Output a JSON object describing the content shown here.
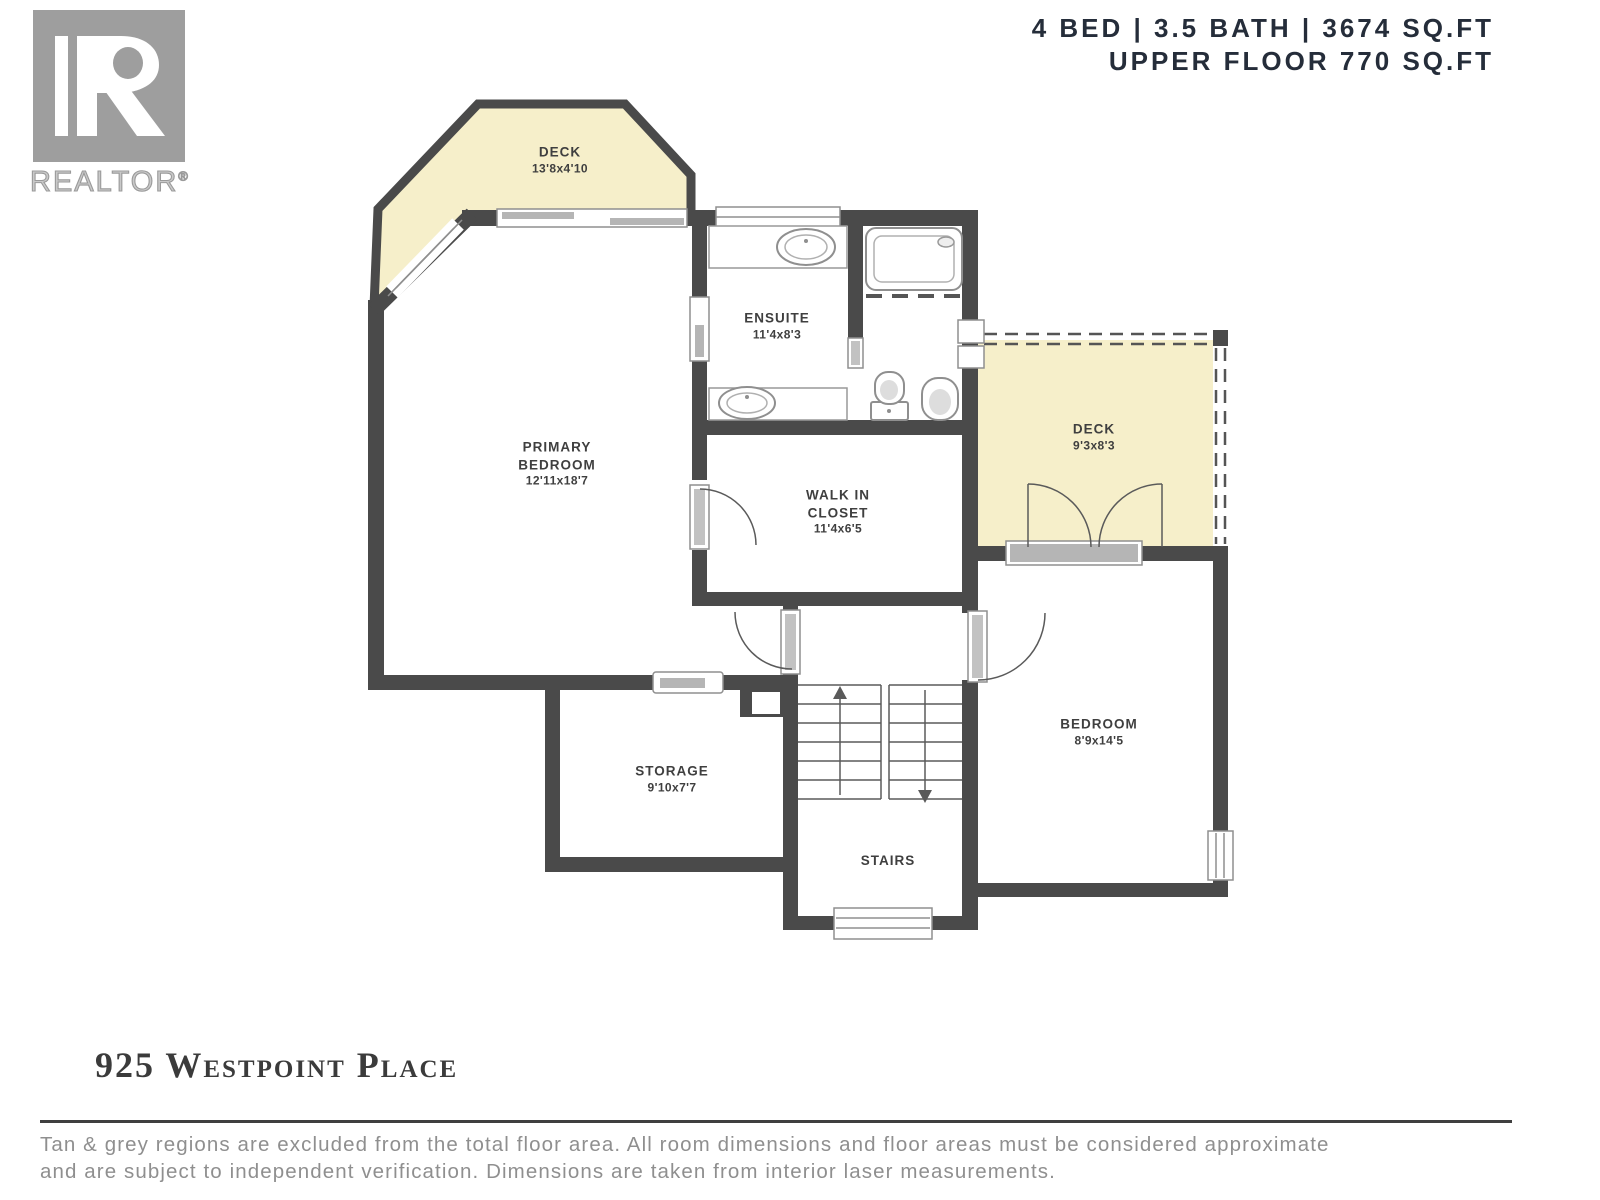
{
  "header": {
    "line1": "4 BED | 3.5 BATH | 3674 SQ.FT",
    "line2": "UPPER FLOOR 770 SQ.FT"
  },
  "logo": {
    "brand": "REALTOR",
    "registered": "®"
  },
  "rooms": {
    "deck_top": {
      "name": "DECK",
      "dims": "13'8x4'10"
    },
    "ensuite": {
      "name": "ENSUITE",
      "dims": "11'4x8'3"
    },
    "primary_bedroom": {
      "line1": "PRIMARY",
      "line2": "BEDROOM",
      "dims": "12'11x18'7"
    },
    "walk_in_closet": {
      "line1": "WALK IN",
      "line2": "CLOSET",
      "dims": "11'4x6'5"
    },
    "deck_right": {
      "name": "DECK",
      "dims": "9'3x8'3"
    },
    "bedroom": {
      "name": "BEDROOM",
      "dims": "8'9x14'5"
    },
    "storage": {
      "name": "STORAGE",
      "dims": "9'10x7'7"
    },
    "stairs": {
      "name": "STAIRS"
    }
  },
  "footer": {
    "address": "925 Westpoint Place",
    "disclaimer_line1": "Tan & grey regions are excluded from the total floor area. All room dimensions and floor areas must be considered approximate",
    "disclaimer_line2": "and are subject to independent verification. Dimensions are taken from interior laser measurements."
  },
  "colors": {
    "wall": "#4a4a4a",
    "deck_fill": "#f6efca",
    "header_text": "#252d3a",
    "label_text": "#3f3f3f",
    "muted_text": "#8f8f8f",
    "logo_gray": "#9e9e9e"
  }
}
